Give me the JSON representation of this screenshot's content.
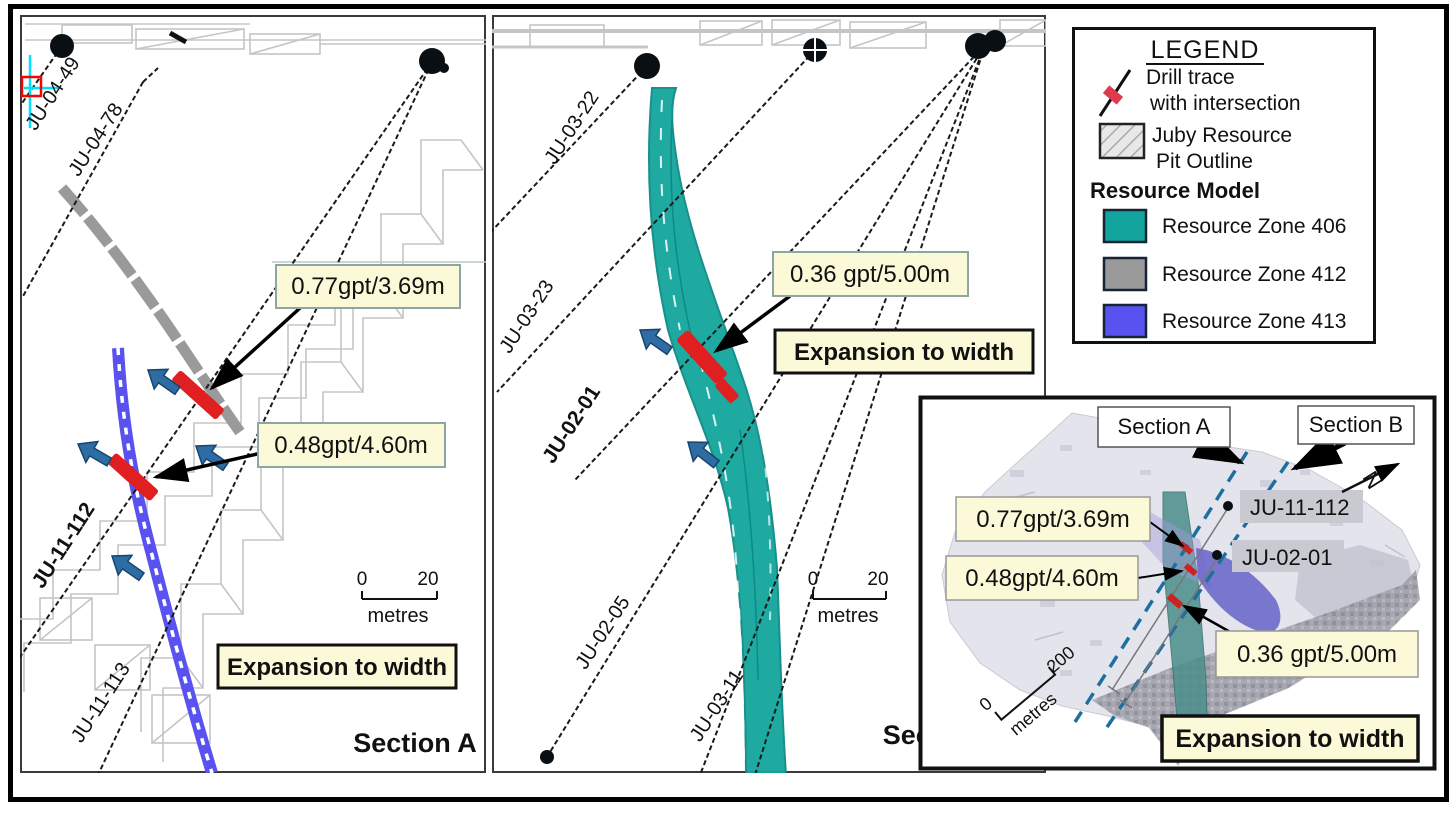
{
  "colors": {
    "zone406_teal": "#13a59d",
    "zone412_gray": "#9a9a9a",
    "zone413_blue": "#5a52f0",
    "intersection_red": "#e02020",
    "arrow_blue": "#2e6da4",
    "annotation_bg": "#fbf9d8",
    "pit_outline_gray": "#c5c5c5",
    "section_line_dash_blue": "#1d6fa0"
  },
  "section_a": {
    "title": "Section A",
    "holes": {
      "h1": "JU-04-49",
      "h2": "JU-04-78",
      "h3": "JU-11-112",
      "h4": "JU-11-113"
    },
    "annotations": {
      "a1": "0.77gpt/3.69m",
      "a2": "0.48gpt/4.60m"
    },
    "expansion": "Expansion to width",
    "scale": {
      "zero": "0",
      "val": "20",
      "unit": "metres"
    }
  },
  "section_b": {
    "title": "Section B",
    "holes": {
      "h1": "JU-03-22",
      "h2": "JU-03-23",
      "h3": "JU-02-01",
      "h4": "JU-02-05",
      "h5": "JU-03-11"
    },
    "annotations": {
      "a1": "0.36 gpt/5.00m"
    },
    "expansion": "Expansion to width",
    "scale": {
      "zero": "0",
      "val": "20",
      "unit": "metres"
    }
  },
  "legend": {
    "title": "LEGEND",
    "drill_trace_line1": "Drill trace",
    "drill_trace_line2": "with intersection",
    "pit_line1": "Juby Resource",
    "pit_line2": "Pit Outline",
    "model_heading": "Resource Model",
    "zones": [
      {
        "label": "Resource Zone 406",
        "color": "#13a59d"
      },
      {
        "label": "Resource Zone 412",
        "color": "#9a9a9a"
      },
      {
        "label": "Resource Zone 413",
        "color": "#5a52f0"
      }
    ]
  },
  "inset": {
    "section_a_label": "Section A",
    "section_b_label": "Section B",
    "holes": {
      "h1": "JU-11-112",
      "h2": "JU-02-01"
    },
    "annotations": {
      "a1": "0.77gpt/3.69m",
      "a2": "0.48gpt/4.60m",
      "a3": "0.36 gpt/5.00m"
    },
    "expansion": "Expansion to width",
    "scale": {
      "zero": "0",
      "val": "200",
      "unit": "metres"
    },
    "north": "N"
  }
}
